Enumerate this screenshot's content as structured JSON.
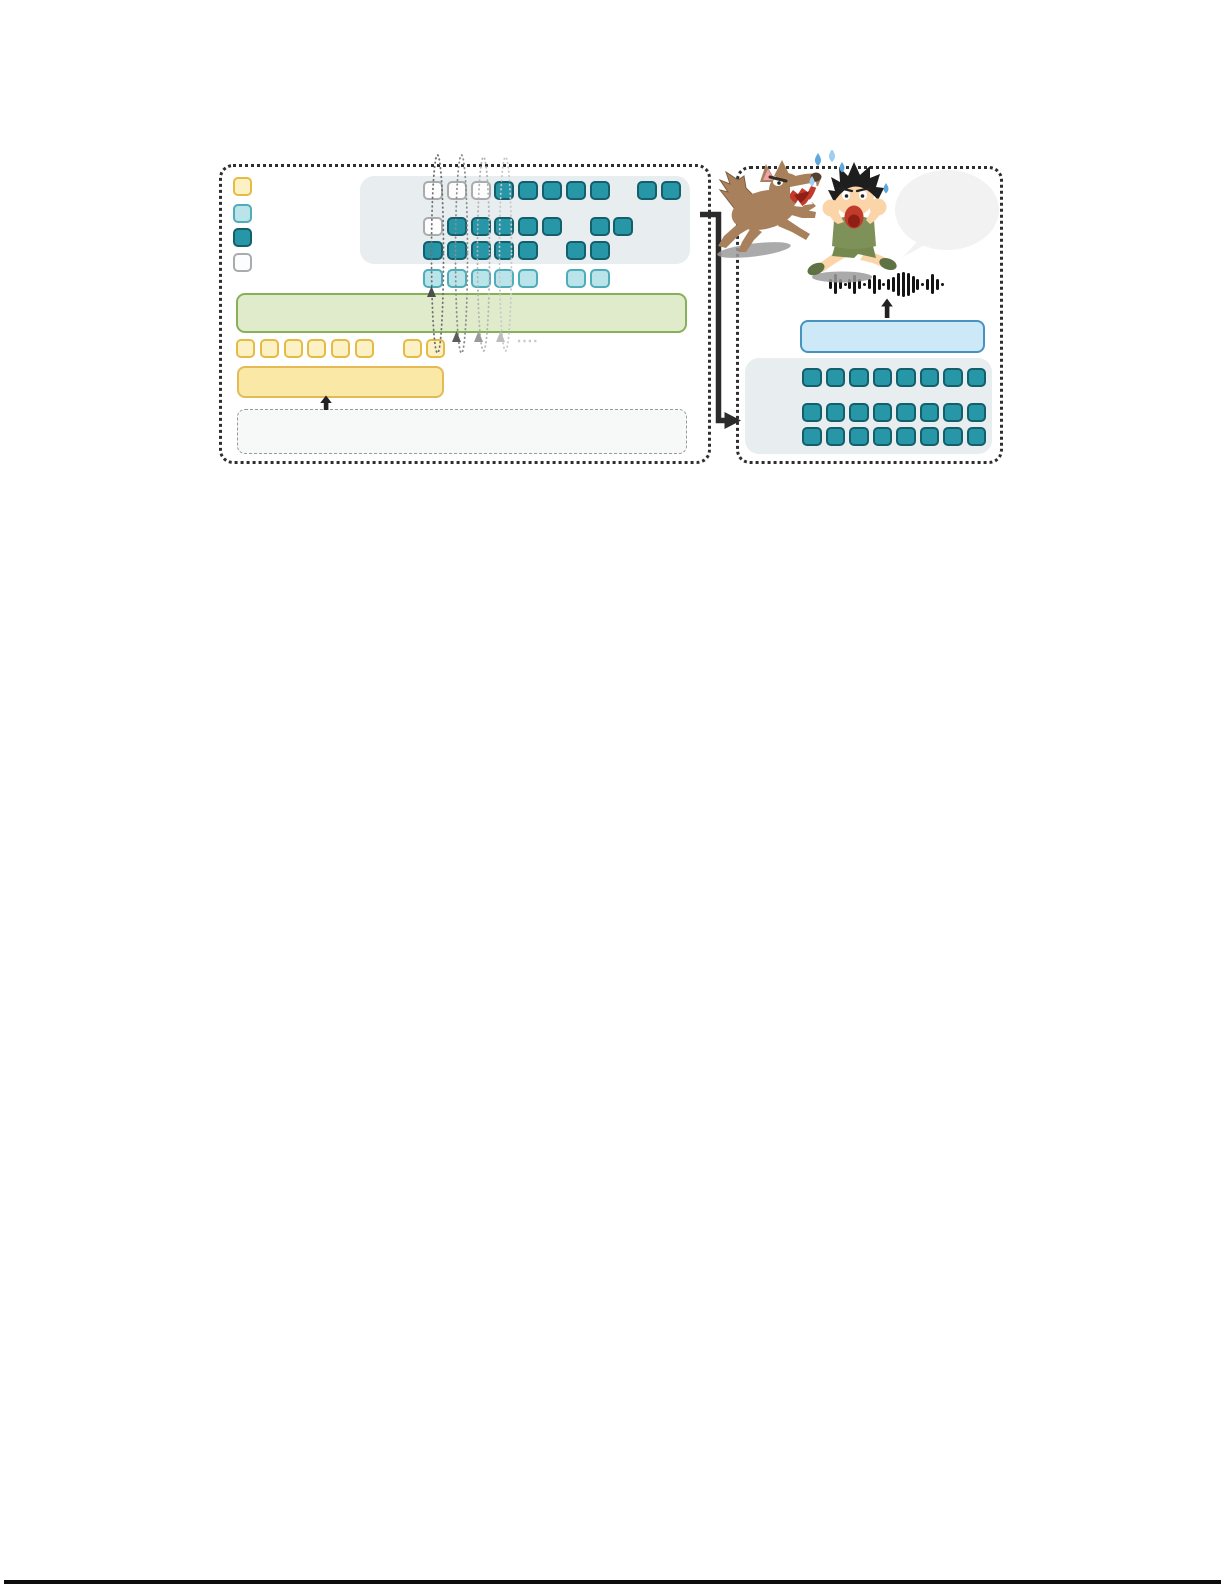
{
  "page": {
    "background": "#ffffff",
    "panel_border": "#2e2e2e",
    "bottom_rule_color": "#0d0d0d"
  },
  "palette": {
    "Y": {
      "label": "yellow-token",
      "fill": "#FCF1C5",
      "border": "#E6BB43"
    },
    "C": {
      "label": "cyan-token",
      "fill": "#B9E4E9",
      "border": "#4FACB9"
    },
    "T": {
      "label": "teal-token",
      "fill": "#2796A6",
      "border": "#135F6C"
    },
    "W": {
      "label": "white-token",
      "fill": "#FDFDFD",
      "border": "#A9ACAE"
    }
  },
  "left_panel": {
    "legend": [
      "Y",
      "C",
      "T",
      "W"
    ],
    "grid_container_fill": "#E8EDEF",
    "token_grid": {
      "rows": [
        "WWWTTTTT.TT",
        "WTTTTT.TT..",
        "TTTTT.TT..."
      ]
    },
    "semantic_row": "CCCCC.CC...",
    "text_row": "YYYYYY.YY",
    "green_bar": {
      "fill": "#DFEBCB",
      "border": "#86B159"
    },
    "yellow_bar": {
      "fill": "#FAE8A6",
      "border": "#E4BA55"
    },
    "input_box": {
      "fill": "#F7F8F8",
      "border": "#96989A"
    },
    "arrow_color": "#222222",
    "loops": [
      {
        "stroke": "#6f6f6f",
        "head": "#4d4d4d"
      },
      {
        "stroke": "#8c8c8c",
        "head": "#5c5c5c"
      },
      {
        "stroke": "#b4b4b4",
        "head": "#9a9a9a"
      },
      {
        "stroke": "#c9c9c9",
        "head": "#bdbdbd"
      }
    ]
  },
  "connector": {
    "color": "#2b2b2b"
  },
  "right_panel": {
    "grid_container_fill": "#E8EDEF",
    "token_grid": {
      "rows": [
        "TTTTTTTT",
        "TTTTTTTT",
        "TTTTTTTT"
      ]
    },
    "blue_bar": {
      "fill": "#CDE8F7",
      "border": "#4793C0"
    },
    "arrow_color": "#222222",
    "waveform": {
      "color": "#141414",
      "heights": [
        10,
        20,
        10,
        3,
        10,
        19,
        10,
        3,
        10,
        19,
        11,
        3,
        11,
        15,
        23,
        25,
        23,
        17,
        11,
        3,
        11,
        20,
        11,
        3
      ]
    },
    "illustration": {
      "wolf_body": "#A8815C",
      "wolf_dark": "#7E5F41",
      "wolf_nose": "#54402E",
      "mouth_red": "#C23A2C",
      "mouth_dark": "#8E1F14",
      "teeth_white": "#FFFFFF",
      "ear_pink": "#F2A3AA",
      "boy_skin": "#FBD5A8",
      "boy_hair": "#1E1E1E",
      "shirt_green": "#7E9158",
      "shorts_green": "#75884E",
      "shoe_green": "#5E7243",
      "sweat_blue": "#5FA8DC",
      "sweat_blue_light": "#9FCEF0",
      "bubble_gray": "#F2F2F3",
      "shadow_gray": "#9B9B9B"
    }
  }
}
